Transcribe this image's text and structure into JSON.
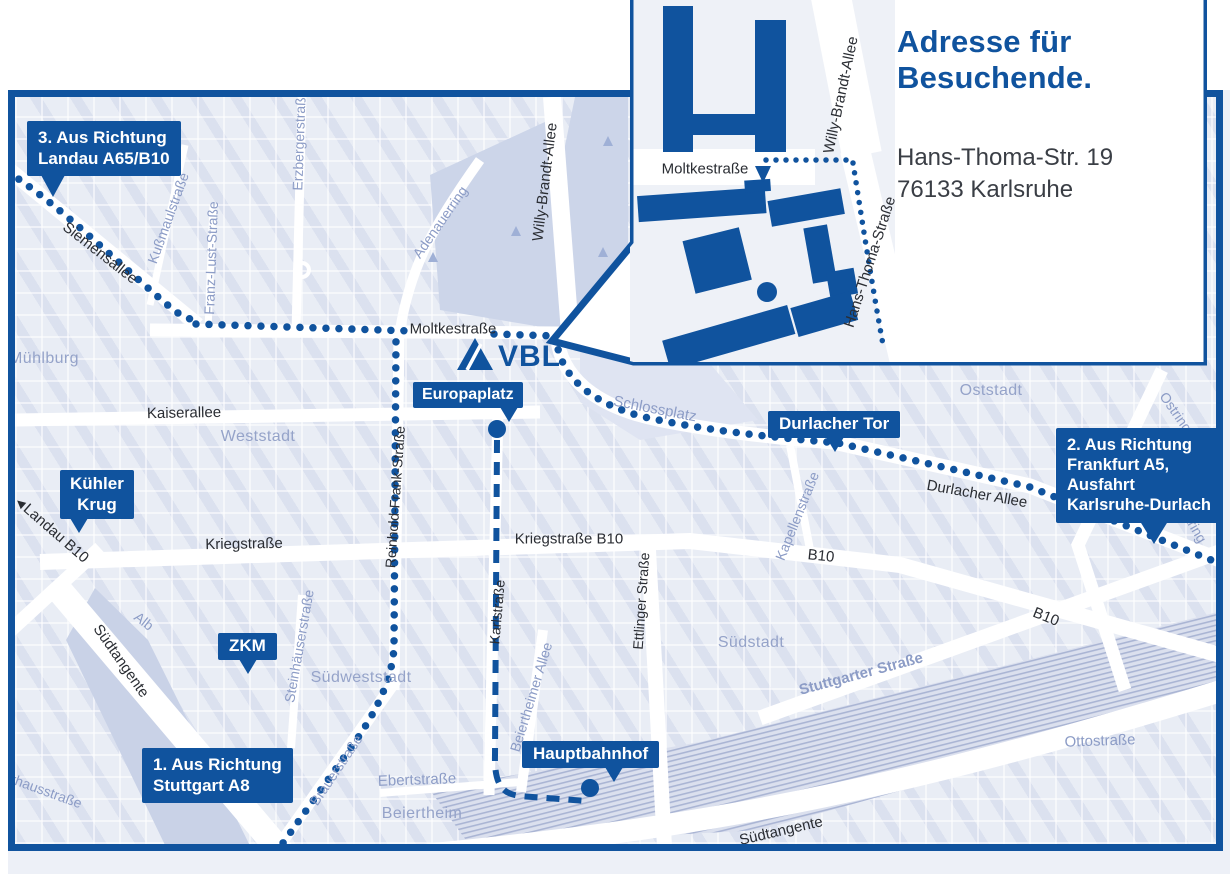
{
  "colors": {
    "accent_blue": "#10539e",
    "map_background": "#e9edf5",
    "park": "#ccd5e9",
    "minor_label": "#8c9cc6",
    "district_label": "#95a3c9",
    "major_label": "#2a2d33",
    "address_text": "#3a3e45"
  },
  "inset": {
    "title": "Adresse für Besuchende.",
    "address_line1": "Hans-Thoma-Str. 19",
    "address_line2": "76133 Karlsruhe",
    "streets": {
      "moltkestrasse": "Moltkestraße",
      "willy_brandt_allee": "Willy-Brandt-Allee",
      "hans_thoma_strasse": "Hans-Thoma-Straße"
    }
  },
  "logo": {
    "text": "VBL"
  },
  "callouts": {
    "route3": {
      "line1": "3. Aus Richtung",
      "line2": "Landau A65/B10"
    },
    "route2": {
      "line1": "2. Aus Richtung",
      "line2": "Frankfurt A5,",
      "line3": "Ausfahrt",
      "line4": "Karlsruhe-Durlach"
    },
    "route1": {
      "line1": "1. Aus Richtung",
      "line2": "Stuttgart A8"
    },
    "kuehler_krug": {
      "line1": "Kühler",
      "line2": "Krug"
    },
    "zkm": {
      "label": "ZKM"
    },
    "europaplatz": {
      "label": "Europaplatz"
    },
    "durlacher_tor": {
      "label": "Durlacher Tor"
    },
    "hauptbahnhof": {
      "label": "Hauptbahnhof"
    }
  },
  "districts": {
    "muehlburg": "Mühlburg",
    "weststadt": "Weststadt",
    "oststadt": "Oststadt",
    "suedweststadt": "Südweststadt",
    "suedstadt": "Südstadt",
    "beiertheim": "Beiertheim"
  },
  "streets": {
    "siemensallee": "Siemensallee",
    "kussmaulstrasse": "Kußmaulstraße",
    "franz_lust_strasse": "Franz-Lust-Straße",
    "erzbergerstrasse": "Erzbergerstraße",
    "adenauerring": "Adenauerring",
    "willy_brandt_allee": "Willy-Brandt-Allee",
    "moltkestrasse": "Moltkestraße",
    "kaiserallee": "Kaiserallee",
    "landau_b10": "Landau B10",
    "kriegstrasse": "Kriegstraße",
    "kriegstrasse_b10": "Kriegstraße B10",
    "reinhold_frank_strasse": "Reinhold-Frank-Straße",
    "karlstrasse": "Karlstraße",
    "ettlinger_strasse": "Ettlinger Straße",
    "schlossplatz": "Schlossplatz",
    "kapellenstrasse": "Kapellenstraße",
    "durlacher_allee": "Durlacher Allee",
    "ostring_a": "Ostring",
    "ostring_b": "Ostring",
    "b10_mid": "B10",
    "b10_east": "B10",
    "suedtangente_west": "Südtangente",
    "suedtangente_sued": "Südtangente",
    "alb": "Alb",
    "steinhaeuserstrasse": "Steinhäuserstraße",
    "brauerstrasse": "Brauerstraße",
    "ebertstrasse": "Ebertstraße",
    "beiertheimer_allee": "Beiertheimer Allee",
    "stuttgarter_strasse": "Stuttgarter Straße",
    "ottostrasse": "Ottostraße",
    "pulverhausstrasse": "Pulverhausstraße"
  },
  "icons": {
    "landau_arrow": "◀"
  }
}
